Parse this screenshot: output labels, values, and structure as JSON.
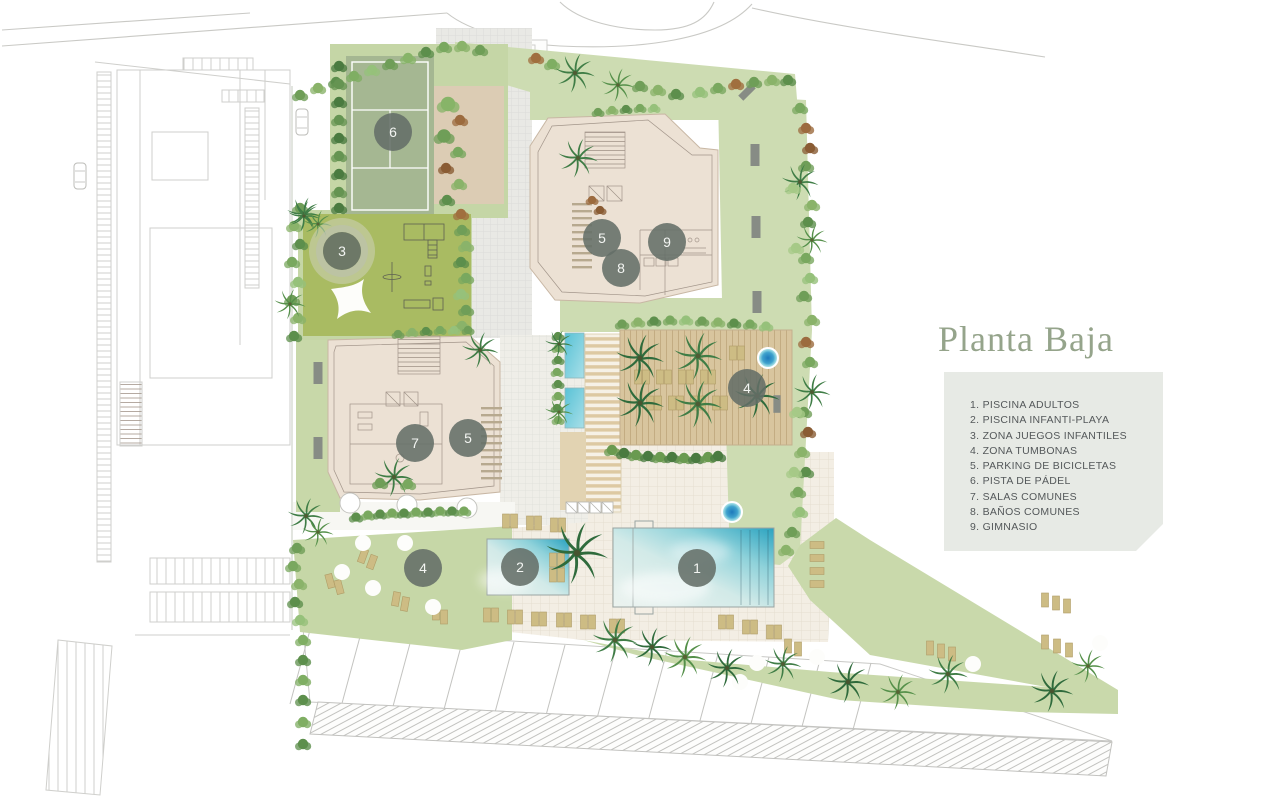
{
  "title": "Planta Baja",
  "legend": {
    "items": [
      "1. PISCINA ADULTOS",
      "2. PISCINA INFANTI-PLAYA",
      "3. ZONA JUEGOS INFANTILES",
      "4. ZONA TUMBONAS",
      "5. PARKING DE BICICLETAS",
      "6. PISTA DE PÁDEL",
      "7. SALAS COMUNES",
      "8. BAÑOS COMUNES",
      "9. GIMNASIO"
    ]
  },
  "plan": {
    "markers": [
      {
        "number": "1",
        "area": "piscina-adultos"
      },
      {
        "number": "2",
        "area": "piscina-infanti-playa"
      },
      {
        "number": "3",
        "area": "zona-juegos-infantiles"
      },
      {
        "number": "4",
        "area": "zona-tumbonas-deck"
      },
      {
        "number": "4",
        "area": "zona-tumbonas-lawn"
      },
      {
        "number": "5",
        "area": "parking-bicicletas-norte"
      },
      {
        "number": "5",
        "area": "parking-bicicletas-oeste"
      },
      {
        "number": "6",
        "area": "pista-de-padel"
      },
      {
        "number": "7",
        "area": "salas-comunes"
      },
      {
        "number": "8",
        "area": "banos-comunes"
      },
      {
        "number": "9",
        "area": "gimnasio"
      }
    ]
  },
  "colors": {
    "title_text": "#95a48b",
    "legend_background": "#e7eae5",
    "legend_text": "#54585a",
    "marker_background": "#646e68",
    "lawn_green": "#cddcb2",
    "playground_green": "#a9bb62",
    "padel_court_green": "#a5b792",
    "building_beige": "#ece1d4",
    "pool_turquoise": "#2aa3c0",
    "deck_wood": "#d8c59e"
  }
}
